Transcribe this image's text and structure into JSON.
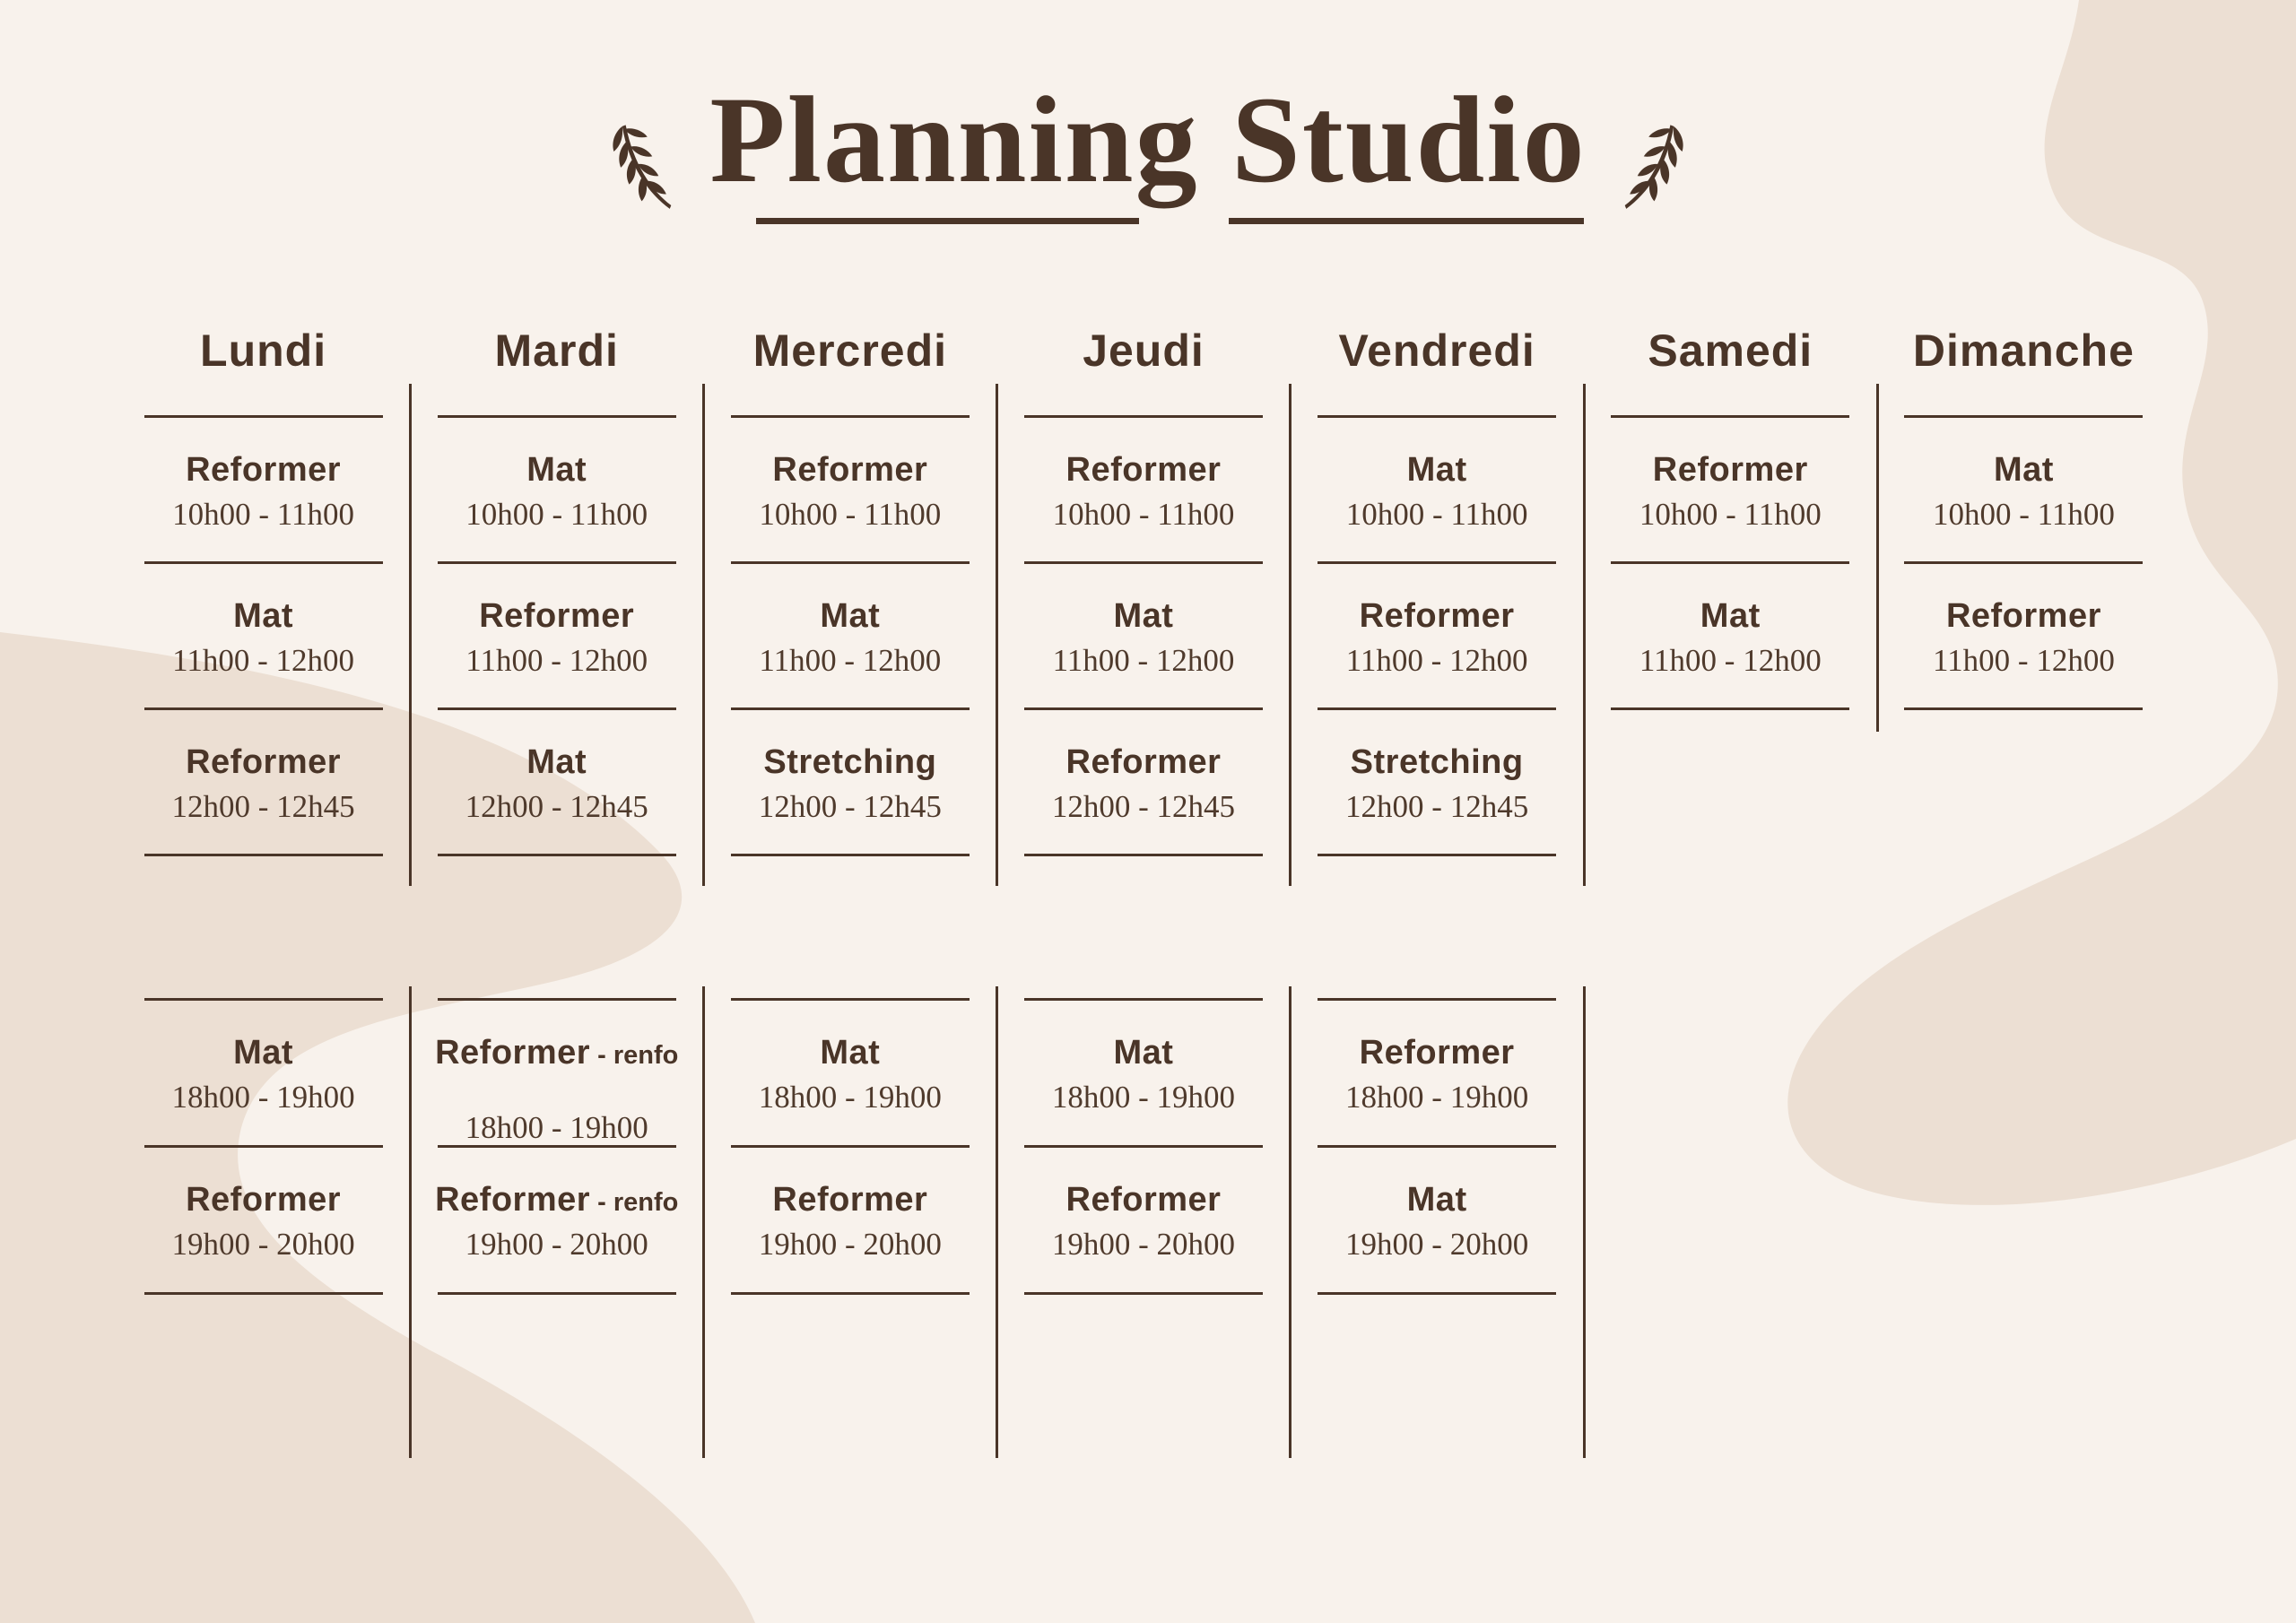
{
  "title": "Planning Studio",
  "colors": {
    "background": "#f8f2ec",
    "blob": "#ecdfd3",
    "ink": "#4a3528"
  },
  "days": [
    {
      "name": "Lundi",
      "morning": [
        {
          "name": "Reformer",
          "time": "10h00 - 11h00"
        },
        {
          "name": "Mat",
          "time": "11h00 - 12h00"
        },
        {
          "name": "Reformer",
          "time": "12h00 - 12h45"
        }
      ],
      "evening": [
        {
          "name": "Mat",
          "time": "18h00 - 19h00"
        },
        {
          "name": "Reformer",
          "time": "19h00 - 20h00"
        }
      ]
    },
    {
      "name": "Mardi",
      "morning": [
        {
          "name": "Mat",
          "time": "10h00 - 11h00"
        },
        {
          "name": "Reformer",
          "time": "11h00 - 12h00"
        },
        {
          "name": "Mat",
          "time": "12h00 - 12h45"
        }
      ],
      "evening": [
        {
          "name": "Reformer",
          "suffix": "renfo",
          "time": "18h00 - 19h00",
          "spaced": true
        },
        {
          "name": "Reformer",
          "suffix": "renfo",
          "time": "19h00 - 20h00"
        }
      ]
    },
    {
      "name": "Mercredi",
      "morning": [
        {
          "name": "Reformer",
          "time": "10h00 - 11h00"
        },
        {
          "name": "Mat",
          "time": "11h00 - 12h00"
        },
        {
          "name": "Stretching",
          "time": "12h00 - 12h45"
        }
      ],
      "evening": [
        {
          "name": "Mat",
          "time": "18h00 - 19h00"
        },
        {
          "name": "Reformer",
          "time": "19h00 - 20h00"
        }
      ]
    },
    {
      "name": "Jeudi",
      "morning": [
        {
          "name": "Reformer",
          "time": "10h00 - 11h00"
        },
        {
          "name": "Mat",
          "time": "11h00 - 12h00"
        },
        {
          "name": "Reformer",
          "time": "12h00 - 12h45"
        }
      ],
      "evening": [
        {
          "name": "Mat",
          "time": "18h00 - 19h00"
        },
        {
          "name": "Reformer",
          "time": "19h00 - 20h00"
        }
      ]
    },
    {
      "name": "Vendredi",
      "morning": [
        {
          "name": "Mat",
          "time": "10h00 - 11h00"
        },
        {
          "name": "Reformer",
          "time": "11h00 - 12h00"
        },
        {
          "name": "Stretching",
          "time": "12h00 - 12h45"
        }
      ],
      "evening": [
        {
          "name": "Reformer",
          "time": "18h00 - 19h00"
        },
        {
          "name": "Mat",
          "time": "19h00 - 20h00"
        }
      ]
    },
    {
      "name": "Samedi",
      "morning": [
        {
          "name": "Reformer",
          "time": "10h00 - 11h00"
        },
        {
          "name": "Mat",
          "time": "11h00 - 12h00"
        }
      ],
      "evening": []
    },
    {
      "name": "Dimanche",
      "morning": [
        {
          "name": "Mat",
          "time": "10h00 - 11h00"
        },
        {
          "name": "Reformer",
          "time": "11h00 - 12h00"
        }
      ],
      "evening": []
    }
  ]
}
